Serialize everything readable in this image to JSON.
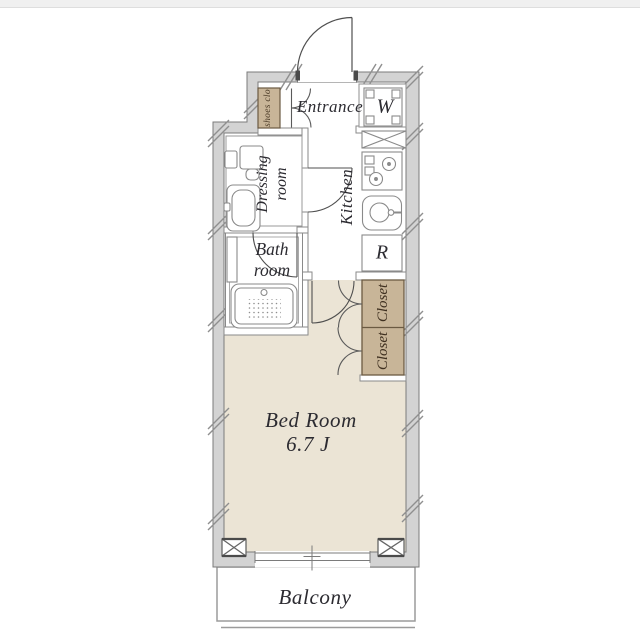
{
  "plan_title": "apartment-floor-plan",
  "rooms": {
    "entrance": {
      "label": "Entrance"
    },
    "washer": {
      "label": "W"
    },
    "shoes_closet": {
      "label": "shoes clo"
    },
    "dressing_room": {
      "line1": "Dressing",
      "line2": "room"
    },
    "kitchen": {
      "label": "Kitchen"
    },
    "bath_room": {
      "line1": "Bath",
      "line2": "room"
    },
    "refrigerator": {
      "label": "R"
    },
    "closet_upper": {
      "label": "Closet"
    },
    "closet_lower": {
      "label": "Closet"
    },
    "bedroom": {
      "label": "Bed Room",
      "size": "6.7 J"
    },
    "balcony": {
      "label": "Balcony"
    }
  },
  "colors": {
    "wall_fill": "#d3d3d3",
    "wall_outline": "#7b7b7b",
    "bedroom_floor": "#ebe4d5",
    "closet_fill": "#c8b598",
    "closet_outline": "#6b5a42",
    "label_color": "#2c2b31",
    "closet_label_color": "#3f3020",
    "shoes_label_color": "#4a3a26"
  }
}
